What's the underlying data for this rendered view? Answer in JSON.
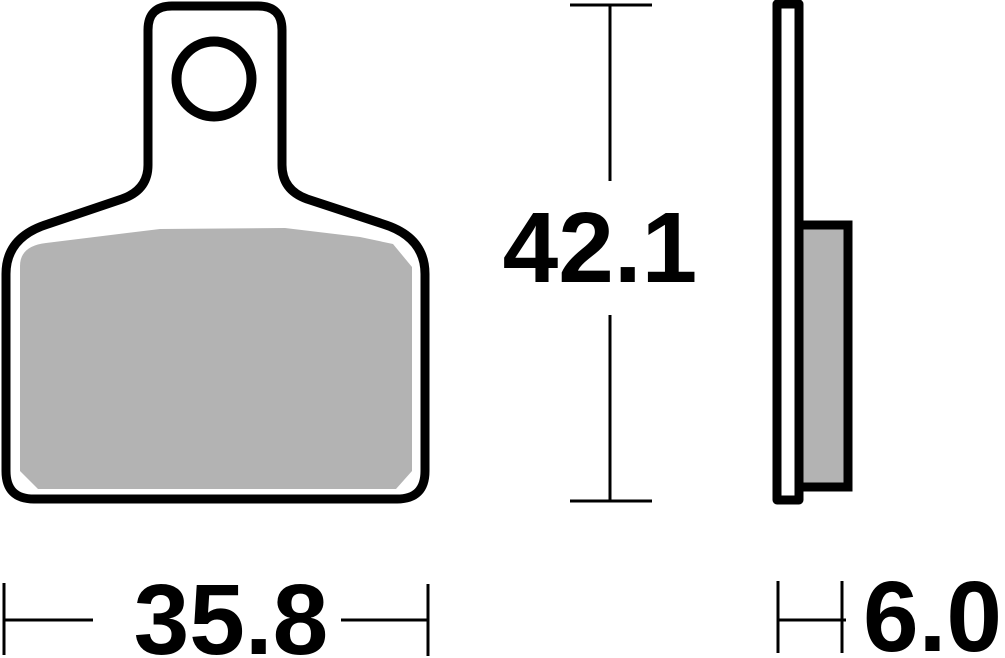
{
  "colors": {
    "outline": "#000000",
    "pad_fill": "#b3b3b3",
    "background": "#ffffff"
  },
  "dimensions": {
    "height": {
      "label": "42.1"
    },
    "width": {
      "label": "35.8"
    },
    "thickness": {
      "label": "6.0"
    }
  }
}
